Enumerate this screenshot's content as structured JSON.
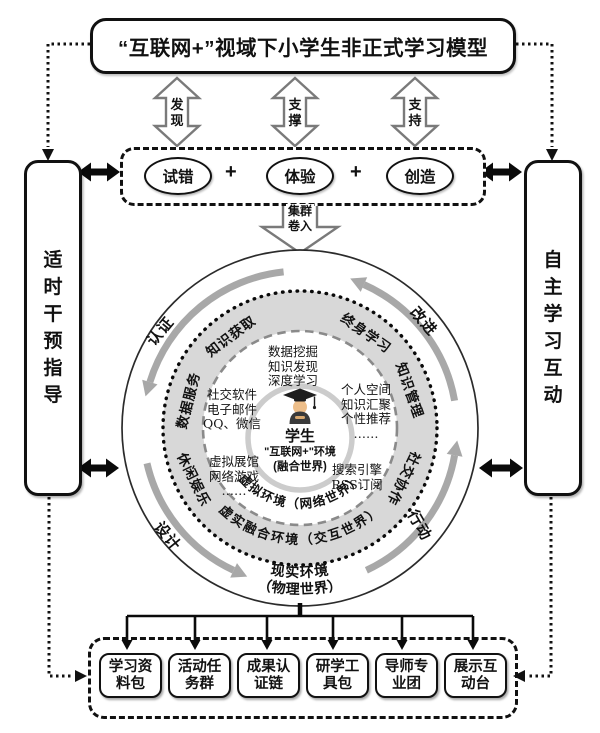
{
  "title": "“互联网+”视域下小学生非正式学习模型",
  "top_arrows": [
    "发现",
    "支撑",
    "支持"
  ],
  "process": {
    "items": [
      "试错",
      "体验",
      "创造"
    ],
    "plus": "+"
  },
  "cluster_label": "集群卷入",
  "left_panel": "适时干预指导",
  "right_panel": "自主学习互动",
  "cycle_labels": [
    "认证",
    "改进",
    "设计",
    "行动"
  ],
  "ring_labels": [
    "知识获取",
    "终身学习",
    "数据服务",
    "知识管理",
    "休闲娱乐",
    "社交协作"
  ],
  "bands": {
    "virtual": "虚拟环境（网络世界）",
    "mixed": "虚实融合环境（交互世界）",
    "real1": "现实环境",
    "real2": "（物理世界）"
  },
  "items": {
    "top": [
      "数据挖掘",
      "知识发现",
      "深度学习"
    ],
    "right": [
      "个人空间",
      "知识汇聚",
      "个性推荐",
      "……"
    ],
    "left": [
      "社交软件",
      "电子邮件",
      "QQ、微信"
    ],
    "bottom_left": [
      "虚拟展馆",
      "网络游戏",
      "……"
    ],
    "bottom_right": [
      "搜索引擎",
      "RSS订阅"
    ]
  },
  "center": {
    "who": "学生",
    "env": "\"互联网+\"环境",
    "world": "(融合世界)"
  },
  "bottom_boxes": [
    {
      "l1": "学习资",
      "l2": "料包"
    },
    {
      "l1": "活动任",
      "l2": "务群"
    },
    {
      "l1": "成果认",
      "l2": "证链"
    },
    {
      "l1": "研学工",
      "l2": "具包"
    },
    {
      "l1": "导师专",
      "l2": "业团"
    },
    {
      "l1": "展示互",
      "l2": "动台"
    }
  ]
}
